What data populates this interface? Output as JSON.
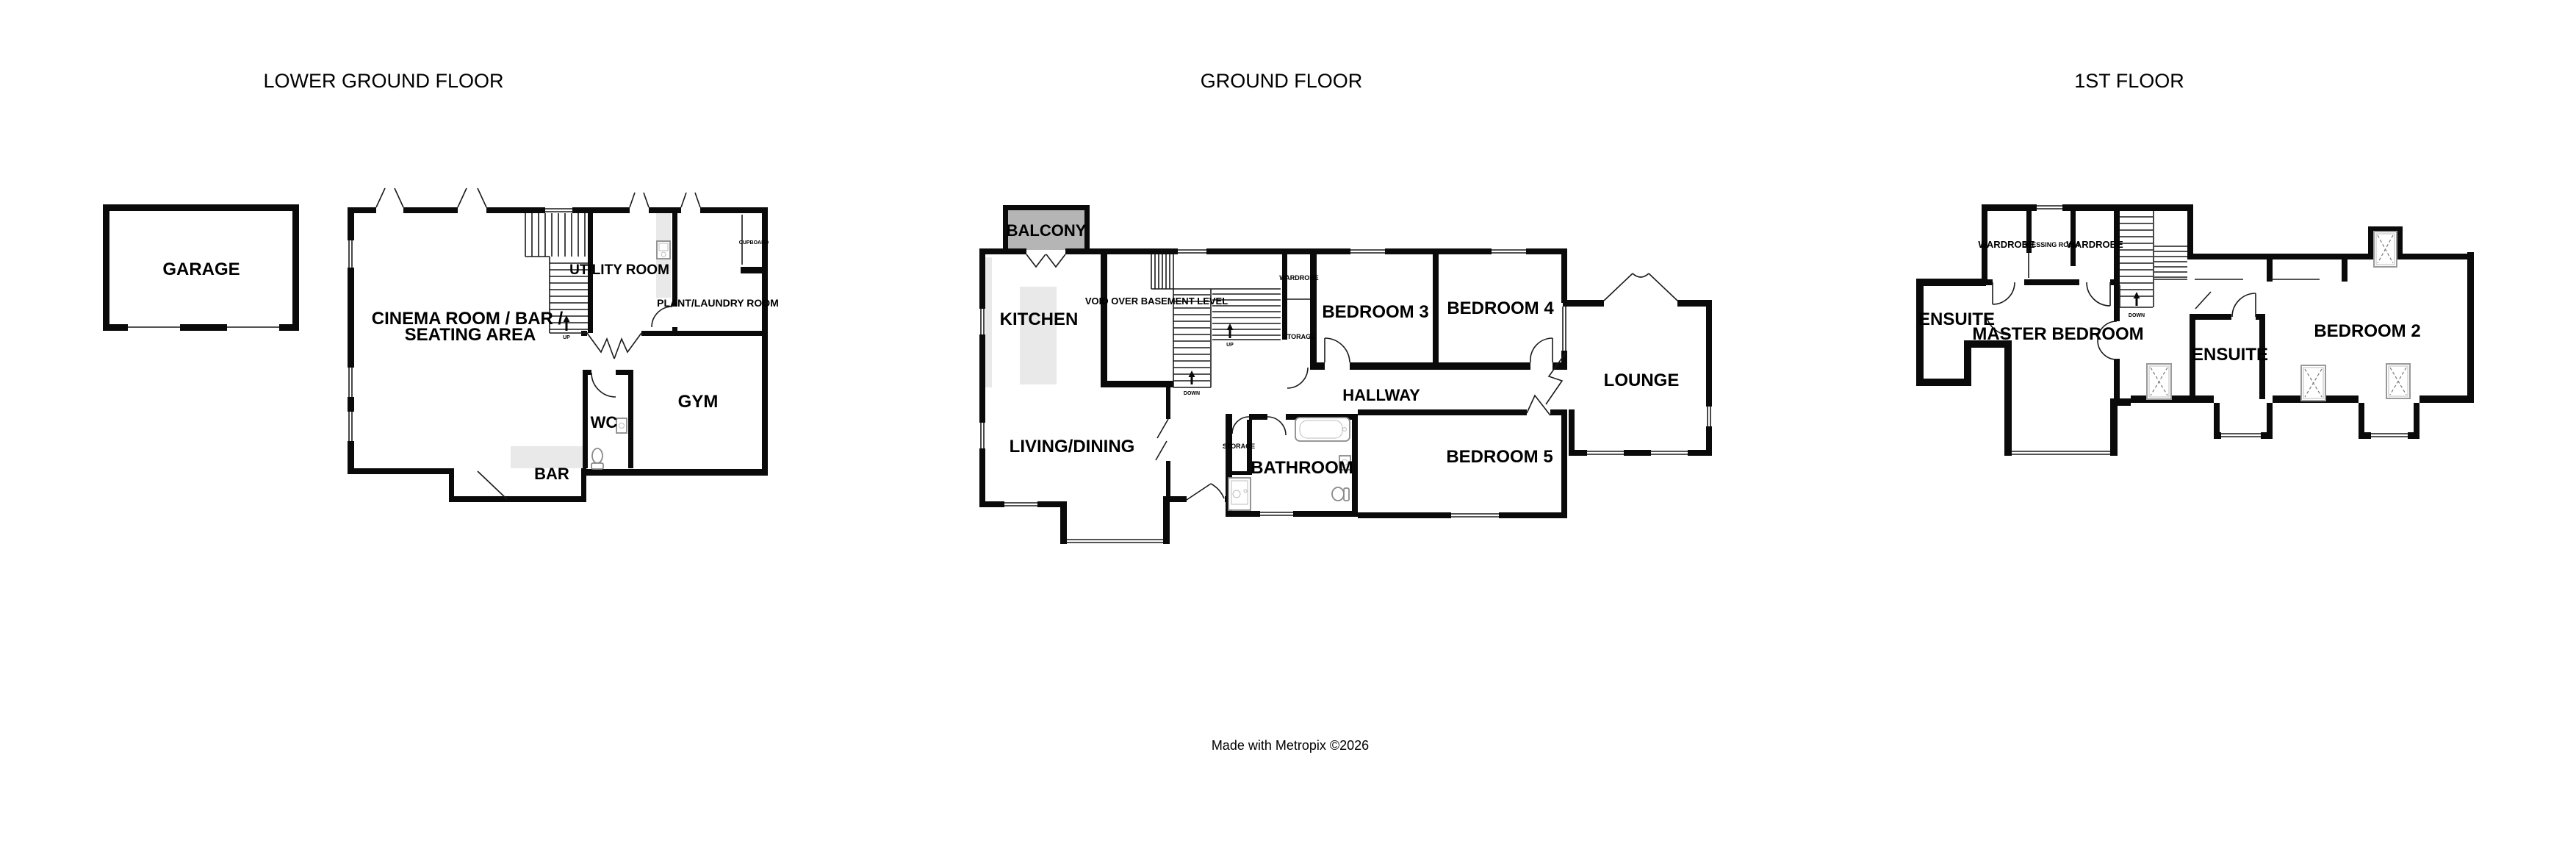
{
  "colors": {
    "wall": "#0a0a0a",
    "balcony_fill": "#b5b5b5",
    "counter_fill": "#e9e9e9",
    "text": "#000000",
    "background": "#ffffff"
  },
  "floors": {
    "lower": {
      "title": "LOWER GROUND FLOOR",
      "garage": "GARAGE",
      "cinema1": "CINEMA ROOM / BAR /",
      "cinema2": "SEATING AREA",
      "utility": "UTILITY ROOM",
      "cupboard": "CUPBOARD",
      "plant": "PLANT/LAUNDRY ROOM",
      "gym": "GYM",
      "wc": "WC",
      "bar": "BAR",
      "up": "UP"
    },
    "ground": {
      "title": "GROUND FLOOR",
      "balcony": "BALCONY",
      "kitchen": "KITCHEN",
      "void_label": "VOID OVER BASEMENT LEVEL",
      "wardrobe": "WARDROBE",
      "storage_top": "STORAGE",
      "bedroom3": "BEDROOM 3",
      "bedroom4": "BEDROOM 4",
      "hallway": "HALLWAY",
      "lounge": "LOUNGE",
      "living": "LIVING/DINING",
      "storage_mid": "STORAGE",
      "bathroom": "BATHROOM",
      "bedroom5": "BEDROOM 5",
      "up": "UP",
      "down": "DOWN"
    },
    "first": {
      "title": "1ST FLOOR",
      "wardrobe_left": "WARDROBE",
      "dressing": "DRESSING ROOM",
      "wardrobe_right": "WARDROBE",
      "ensuite_left": "ENSUITE",
      "master": "MASTER BEDROOM",
      "ensuite_mid": "ENSUITE",
      "bedroom2": "BEDROOM 2",
      "down": "DOWN"
    }
  },
  "footer": {
    "credit": "Made with Metropix ©2026"
  }
}
